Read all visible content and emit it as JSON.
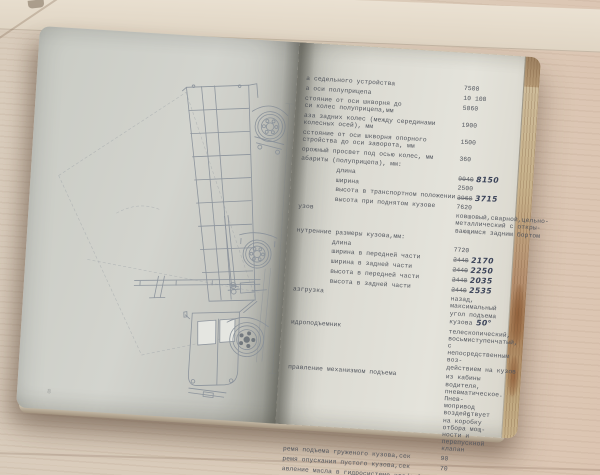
{
  "scene": {
    "description": "open typewritten technical manual (dump semi-trailer specifications) lying on a light wooden table",
    "colors": {
      "wood": "#d9c8b6",
      "paper_left": "#ced0c9",
      "paper_right": "#e0e0d8",
      "typewriter_ink": "#51555d",
      "handwriting_ink": "#3b4359",
      "page_edge_tan": "#c3a87e"
    }
  },
  "left_page": {
    "page_number": "8",
    "drawing": "dump-truck-semitrailer-side-view-with-raised-body"
  },
  "right_page": {
    "page_number": "9",
    "rows": [
      {
        "label": "а седельного устройства",
        "value": "7500"
      },
      {
        "label": "а оси полуприцепа",
        "value": "10 100"
      },
      {
        "label": "стояние от оси шкворня до\nси колес полуприцепа,мм",
        "value": "5060"
      },
      {
        "label": "аза задних колес (между серединами\nколесных осей), мм",
        "value": "1900"
      },
      {
        "label": "сстояние от оси шкворня опорного\nстройства до оси заворота, мм",
        "value": "1500"
      },
      {
        "label": "орожный просвет под осью колес, мм",
        "value": "360"
      },
      {
        "label": "абариты (полуприцепа), мм:",
        "value": ""
      },
      {
        "label": "длина",
        "indent": 1,
        "strike": "9040",
        "hand": "8150"
      },
      {
        "label": "ширина",
        "indent": 1,
        "value": "2500"
      },
      {
        "label": "высота в транспортном положении",
        "indent": 1,
        "strike": "3960",
        "hand": "3715"
      },
      {
        "label": "высота при поднятом кузове",
        "indent": 1,
        "value": "7620"
      },
      {
        "label": "узов",
        "value": "ковшовый,сварной,цельно-\nметаллический с откры-\nвающимся задним бортом"
      },
      {
        "label": "нутренние размеры кузова,мм:",
        "value": ""
      },
      {
        "label": "длина",
        "indent": 1,
        "value": "7720"
      },
      {
        "label": "ширина в передней части",
        "indent": 1,
        "strike": "2440",
        "hand": "2170"
      },
      {
        "label": "ширина в задней части",
        "indent": 1,
        "strike": "2440",
        "hand": "2250"
      },
      {
        "label": "высота в передней части",
        "indent": 1,
        "strike": "2440",
        "hand": "2035"
      },
      {
        "label": "высота в задней части",
        "indent": 1,
        "strike": "2440",
        "hand": "2535"
      },
      {
        "label": "азгрузка",
        "value": "назад, максимальный\nугол подъема кузова",
        "hand": "50°"
      },
      {
        "label": "идроподъемник",
        "value": "телескопический,\nвосьмиступенчатый, с\nнепосредственным воз-\nдействием на кузов"
      },
      {
        "label": "правление механизмом подъема",
        "value": "из кабины водителя,\nпневматическое. Пнев-\nмопривод воздействует\nна коробку отбора мощ-\nности и перепускной\nклапан"
      },
      {
        "label": "ремя подъема груженого кузова,сек",
        "value": "90"
      },
      {
        "label": "ремя опускания пустого кузова,сек",
        "value": "70"
      },
      {
        "label": "авление масла в гидросистеме,кгс/см²",
        "value": "100"
      }
    ]
  }
}
